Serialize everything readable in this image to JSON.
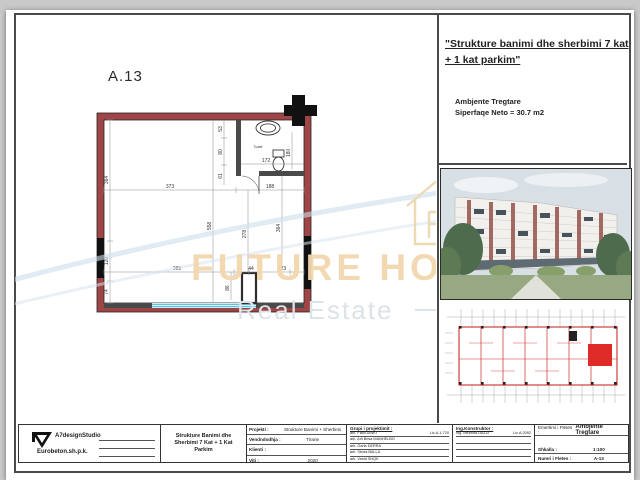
{
  "page": {
    "sheet_label": "A.13"
  },
  "right_panel": {
    "title_line1": "\"Strukture banimi dhe sherbimi 7 kat",
    "title_line2": "+ 1 kat parkim\"",
    "subtitle1": "Ambjente Tregtare",
    "subtitle2": "Siperfaqe Neto = 30.7 m2"
  },
  "watermark": {
    "line1": "FUTURE HOME",
    "line2": "Real Estate"
  },
  "plan": {
    "room_label": "Tualet",
    "dims": {
      "top1": "373",
      "top2": "188",
      "left1": "364",
      "left2": "120",
      "left3": "74",
      "mid1": "558",
      "mid2": "278",
      "right1": "364",
      "wc1": "53",
      "wc2": "80",
      "wc3": "61",
      "wc_w": "172",
      "wc_h": "180",
      "bot1": "385",
      "bot2": "44",
      "bot3": "123",
      "bot4": "86"
    }
  },
  "titleblock": {
    "studio_name": "A7designStudio",
    "company": "Eurobeton.sh.p.k.",
    "project_title_l1": "Strukture Banimi dhe",
    "project_title_l2": "Sherbimi 7 Kat + 1 Kat Parkim",
    "fields": {
      "f1_label": "Projekti :",
      "f1_value": "Strukture Banimi + Sherbimi",
      "f2_label": "Vendndodhja :",
      "f2_value": "Tirane",
      "f3_label": "Klienti :",
      "f3_value": "",
      "f4_label": "Viti :",
      "f4_value": "2020"
    },
    "team_header": "Grupi i projektimit :",
    "team1": "ark. Fladi DINKI",
    "team1_lic": "Lic.A.1-720",
    "team2": "ark. Arli Brisa MANHELBO",
    "team3": "ark. Garla DERRA",
    "team4": "ark. Strola BALLA",
    "team5": "ark. Vanid SHQK",
    "engineer_header": "Ing.Konstruktor :",
    "engineer": "Ing. Miranda DAZZI",
    "engineer_lic": "Lic.A.2092",
    "sheet_name_label": "Emertimi i Fletes :",
    "sheet_name": "Ambjente Tregtare",
    "scale_label": "Shkalla :",
    "scale_value": "1:100",
    "sheet_no_label": "Numri i Fletes :",
    "sheet_no_value": "A-13"
  }
}
